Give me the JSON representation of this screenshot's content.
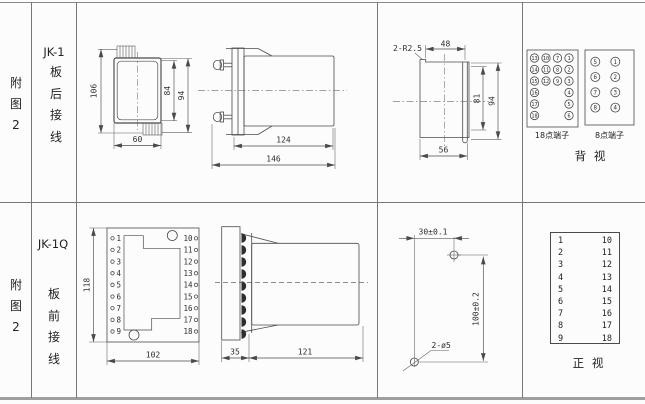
{
  "colors": {
    "ink": "#4a4a4a",
    "background": "#fcfcfc"
  },
  "rows": [
    {
      "figure_label": [
        "附",
        "图",
        "2"
      ],
      "model": "JK-1",
      "wiring": [
        "板",
        "后",
        "接",
        "线"
      ],
      "dims": {
        "height": "106",
        "inner_height": "84",
        "screw_height": "94",
        "width": "60",
        "body_len": "124",
        "total_len": "146",
        "corner_note": "2-R2.5",
        "cut_top": "48",
        "cut_inner": "81",
        "cut_outer": "94",
        "cut_width": "56"
      },
      "terminal18": {
        "label": "18点端子",
        "cols": [
          [
            13,
            14,
            15,
            16,
            17,
            18
          ],
          [
            10,
            11,
            12
          ],
          [
            7,
            8,
            9
          ],
          [
            1,
            2,
            3,
            4,
            5,
            6
          ]
        ]
      },
      "terminal8": {
        "label": "8点端子",
        "cols": [
          [
            5,
            6,
            7,
            8
          ],
          [
            1,
            2,
            3,
            4
          ]
        ]
      },
      "view_label": "背  视"
    },
    {
      "figure_label": [
        "附",
        "图",
        "2"
      ],
      "model": "JK-1Q",
      "wiring": [
        "板",
        "前",
        "接",
        "线"
      ],
      "dims": {
        "height": "118",
        "width": "102",
        "panel_depth": "35",
        "body_len": "121",
        "hole_h": "30±0.1",
        "hole_v": "100±0.2",
        "hole_note": "2-ø5"
      },
      "left_terminals": [
        "1",
        "2",
        "3",
        "4",
        "5",
        "6",
        "7",
        "8",
        "9"
      ],
      "right_terminals": [
        "10",
        "11",
        "12",
        "13",
        "14",
        "15",
        "16",
        "17",
        "18"
      ],
      "table": {
        "left": [
          "1",
          "2",
          "3",
          "4",
          "5",
          "6",
          "7",
          "8",
          "9"
        ],
        "right": [
          "10",
          "11",
          "12",
          "13",
          "14",
          "15",
          "16",
          "17",
          "18"
        ]
      },
      "view_label": "正  视"
    }
  ]
}
